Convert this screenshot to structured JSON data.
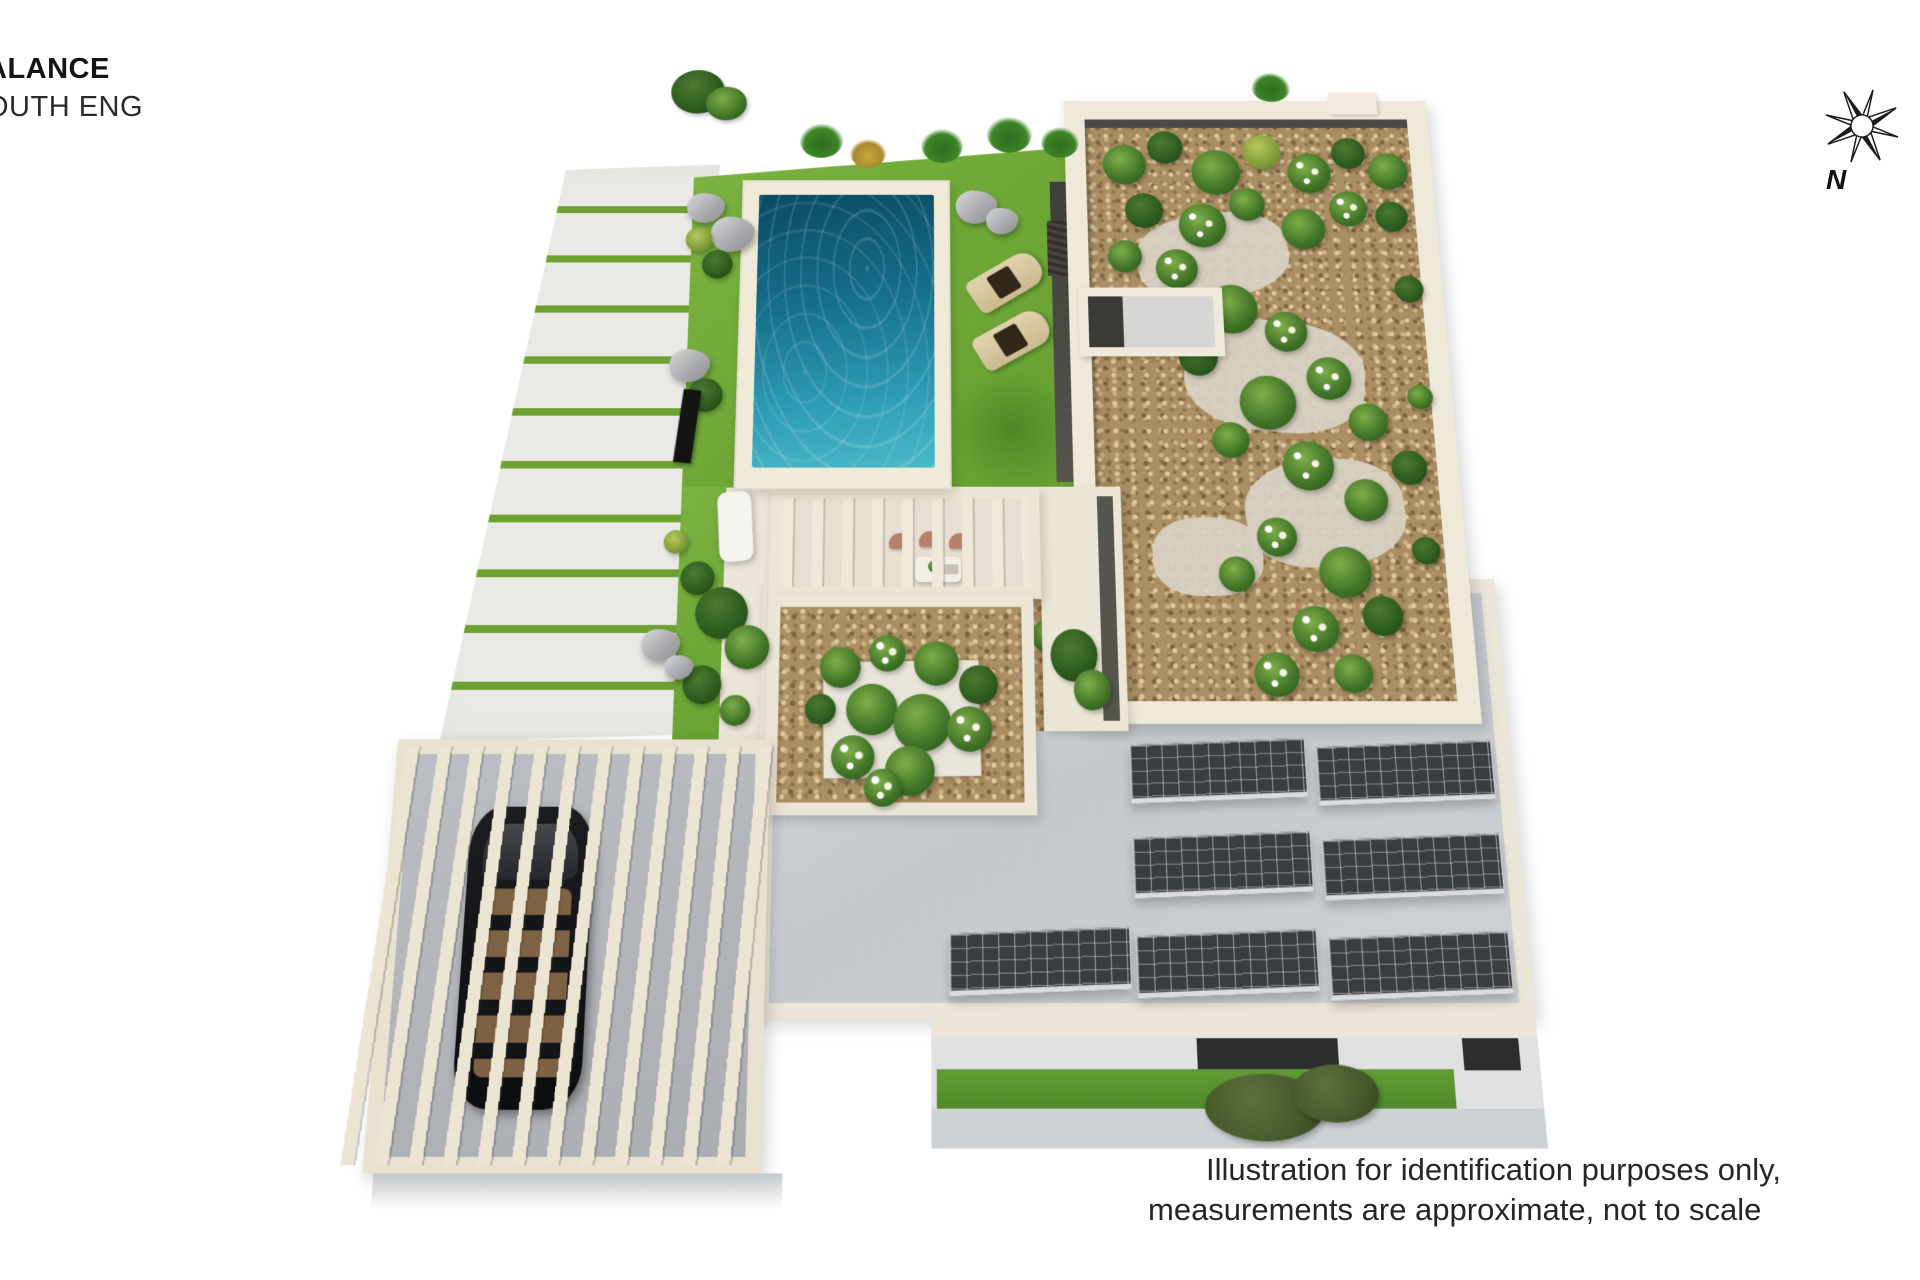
{
  "header": {
    "line1": "ALANCE",
    "line2": "OUTH ENG"
  },
  "compass": {
    "label": "N"
  },
  "disclaimer": {
    "line1": "Illustration for identification purposes only,",
    "line2": "measurements are approximate, not to scale"
  },
  "illustration": {
    "type": "3d-aerial-site-plan",
    "subject": "villa rooftop with pool, gardens, carport pergola and solar panels",
    "solar_panel_count": 7,
    "sun_lounger_count": 2,
    "palette": {
      "background": "#ffffff",
      "pool_water_dark": "#0b4a63",
      "pool_water_light": "#4cb9c9",
      "lawn_green": "#76ac3c",
      "driveway_slab": "#ebe9e5",
      "driveway_joint_green": "#6da230",
      "cream_wall": "#efe9da",
      "gravel": "#ab8e63",
      "roof_gray": "#ced2d6",
      "solar_panel": "#3a3d40",
      "car_body": "#151619",
      "chair_terracotta": "#b5816b"
    }
  }
}
